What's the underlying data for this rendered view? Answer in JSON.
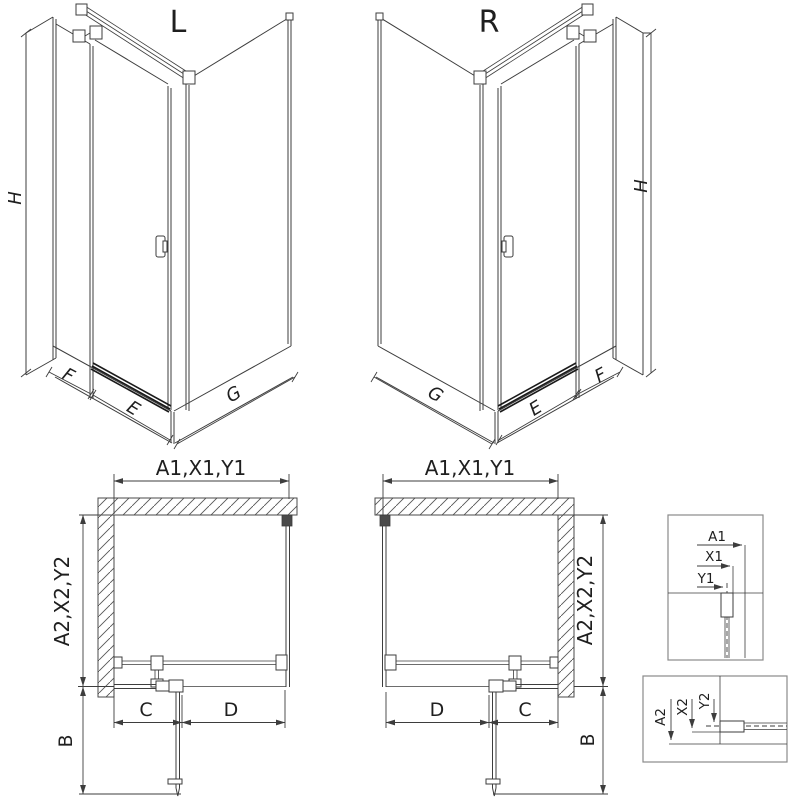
{
  "titles": {
    "left": "L",
    "right": "R"
  },
  "iso_dims": {
    "height": "H",
    "fixed_panel": "F",
    "door": "E",
    "side_panel": "G"
  },
  "plan_dims": {
    "top_width": "A1,X1,Y1",
    "side_depth": "A2,X2,Y2",
    "door_swing": "B",
    "fixed_front": "C",
    "door_width": "D"
  },
  "detail_top": {
    "a": "A1",
    "x": "X1",
    "y": "Y1"
  },
  "detail_bottom": {
    "a": "A2",
    "x": "X2",
    "y": "Y2"
  },
  "colors": {
    "background": "#ffffff",
    "line": "#3d3d3d",
    "dark_rail": "#1a1a1a",
    "text": "#1f1f1f",
    "detail_border": "#8a8a8a",
    "hatch": "#555555"
  }
}
